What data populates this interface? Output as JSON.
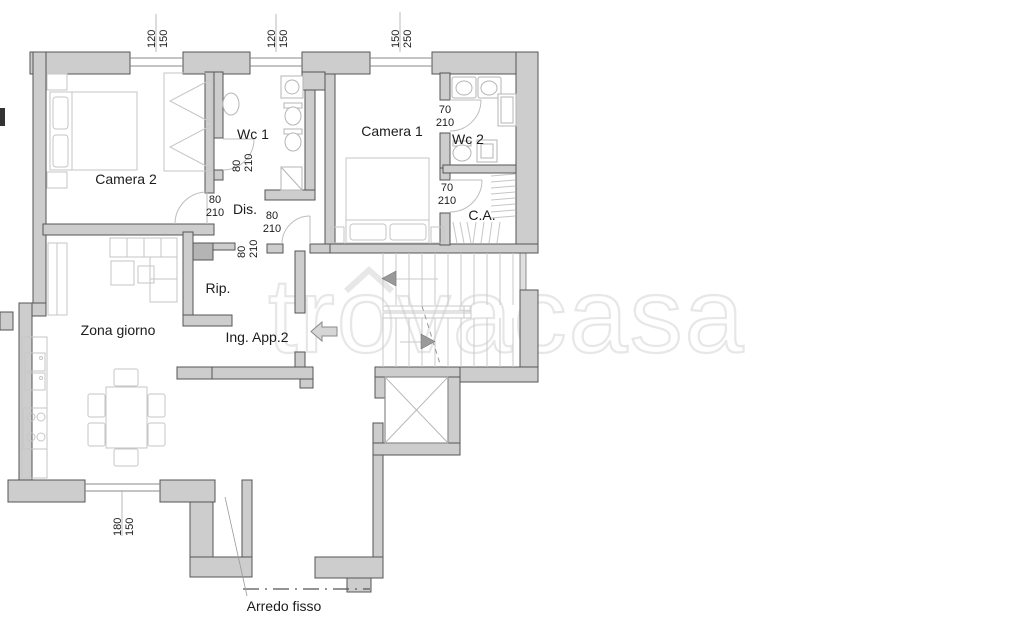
{
  "watermark": {
    "text": "trovacasa"
  },
  "rooms": {
    "camera2": "Camera 2",
    "wc1": "Wc 1",
    "camera1": "Camera 1",
    "wc2": "Wc 2",
    "ca": "C.A.",
    "dis": "Dis.",
    "rip": "Rip.",
    "zona_giorno": "Zona giorno",
    "ingresso": "Ing. App.2"
  },
  "annotations": {
    "arredo_fisso": "Arredo fisso"
  },
  "windows": [
    {
      "id": "win-1",
      "width": "120",
      "height": "150"
    },
    {
      "id": "win-2",
      "width": "120",
      "height": "150"
    },
    {
      "id": "win-3",
      "width": "150",
      "height": "250"
    },
    {
      "id": "win-4",
      "width": "180",
      "height": "150"
    }
  ],
  "doors": {
    "d80": {
      "width": "80",
      "height": "210"
    },
    "d70": {
      "width": "70",
      "height": "210"
    }
  },
  "colors": {
    "wall_fill": "#cdcdcd",
    "wall_stroke": "#555555",
    "furniture": "#c6c6c6",
    "fixture": "#b5b5b5",
    "text": "#1c1c1c",
    "watermark": "#e7e7e7",
    "stair": "#c9c9c9"
  }
}
